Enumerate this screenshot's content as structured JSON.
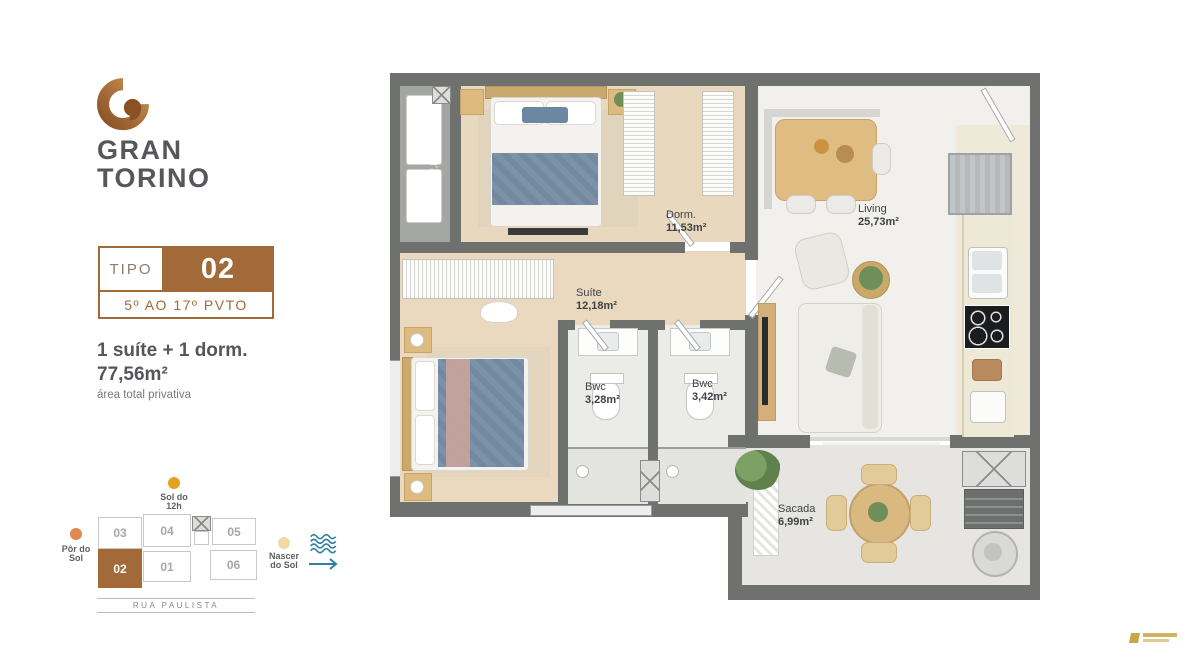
{
  "brand": {
    "line1": "GRAN",
    "line2": "TORINO",
    "logo_icon": "g-spiral-monogram"
  },
  "type_badge": {
    "label": "TIPO",
    "number": "02",
    "floors": "5º AO 17º PVTO"
  },
  "summary": {
    "rooms": "1 suíte + 1 dorm.",
    "area": "77,56m²",
    "note": "área total privativa"
  },
  "orientation": {
    "noon": {
      "line1": "Sol do",
      "line2": "12h",
      "dot_color": "#e3a322"
    },
    "sunset": {
      "line1": "Pôr do",
      "line2": "Sol",
      "dot_color": "#e1884f"
    },
    "sunrise": {
      "line1": "Nascer",
      "line2": "do Sol",
      "dot_color": "#f2d8a3"
    },
    "sea_icon": "waves-arrow-east",
    "street": "RUA PAULISTA",
    "units": [
      {
        "id": "03"
      },
      {
        "id": "04"
      },
      {
        "id": "05"
      },
      {
        "id": "02"
      },
      {
        "id": "01"
      },
      {
        "id": "06"
      }
    ],
    "highlighted_unit": "02"
  },
  "plan": {
    "rooms": [
      {
        "name": "Dorm.",
        "area": "11,53m²"
      },
      {
        "name": "Suíte",
        "area": "12,18m²"
      },
      {
        "name": "Bwc",
        "area": "3,28m²"
      },
      {
        "name": "Bwc",
        "area": "3,42m²"
      },
      {
        "name": "Living",
        "area": "25,73m²"
      },
      {
        "name": "Sacada",
        "area": "6,99m²"
      }
    ],
    "technical_area_label": "A.T. - 2,88m²"
  },
  "colors": {
    "accent_brown": "#a26a38",
    "wall_gray": "#6f716e",
    "wood_floor": "#e8d8bd",
    "bed_blue": "#7a92a9"
  },
  "watermark_icon": "gold-builder-logo"
}
